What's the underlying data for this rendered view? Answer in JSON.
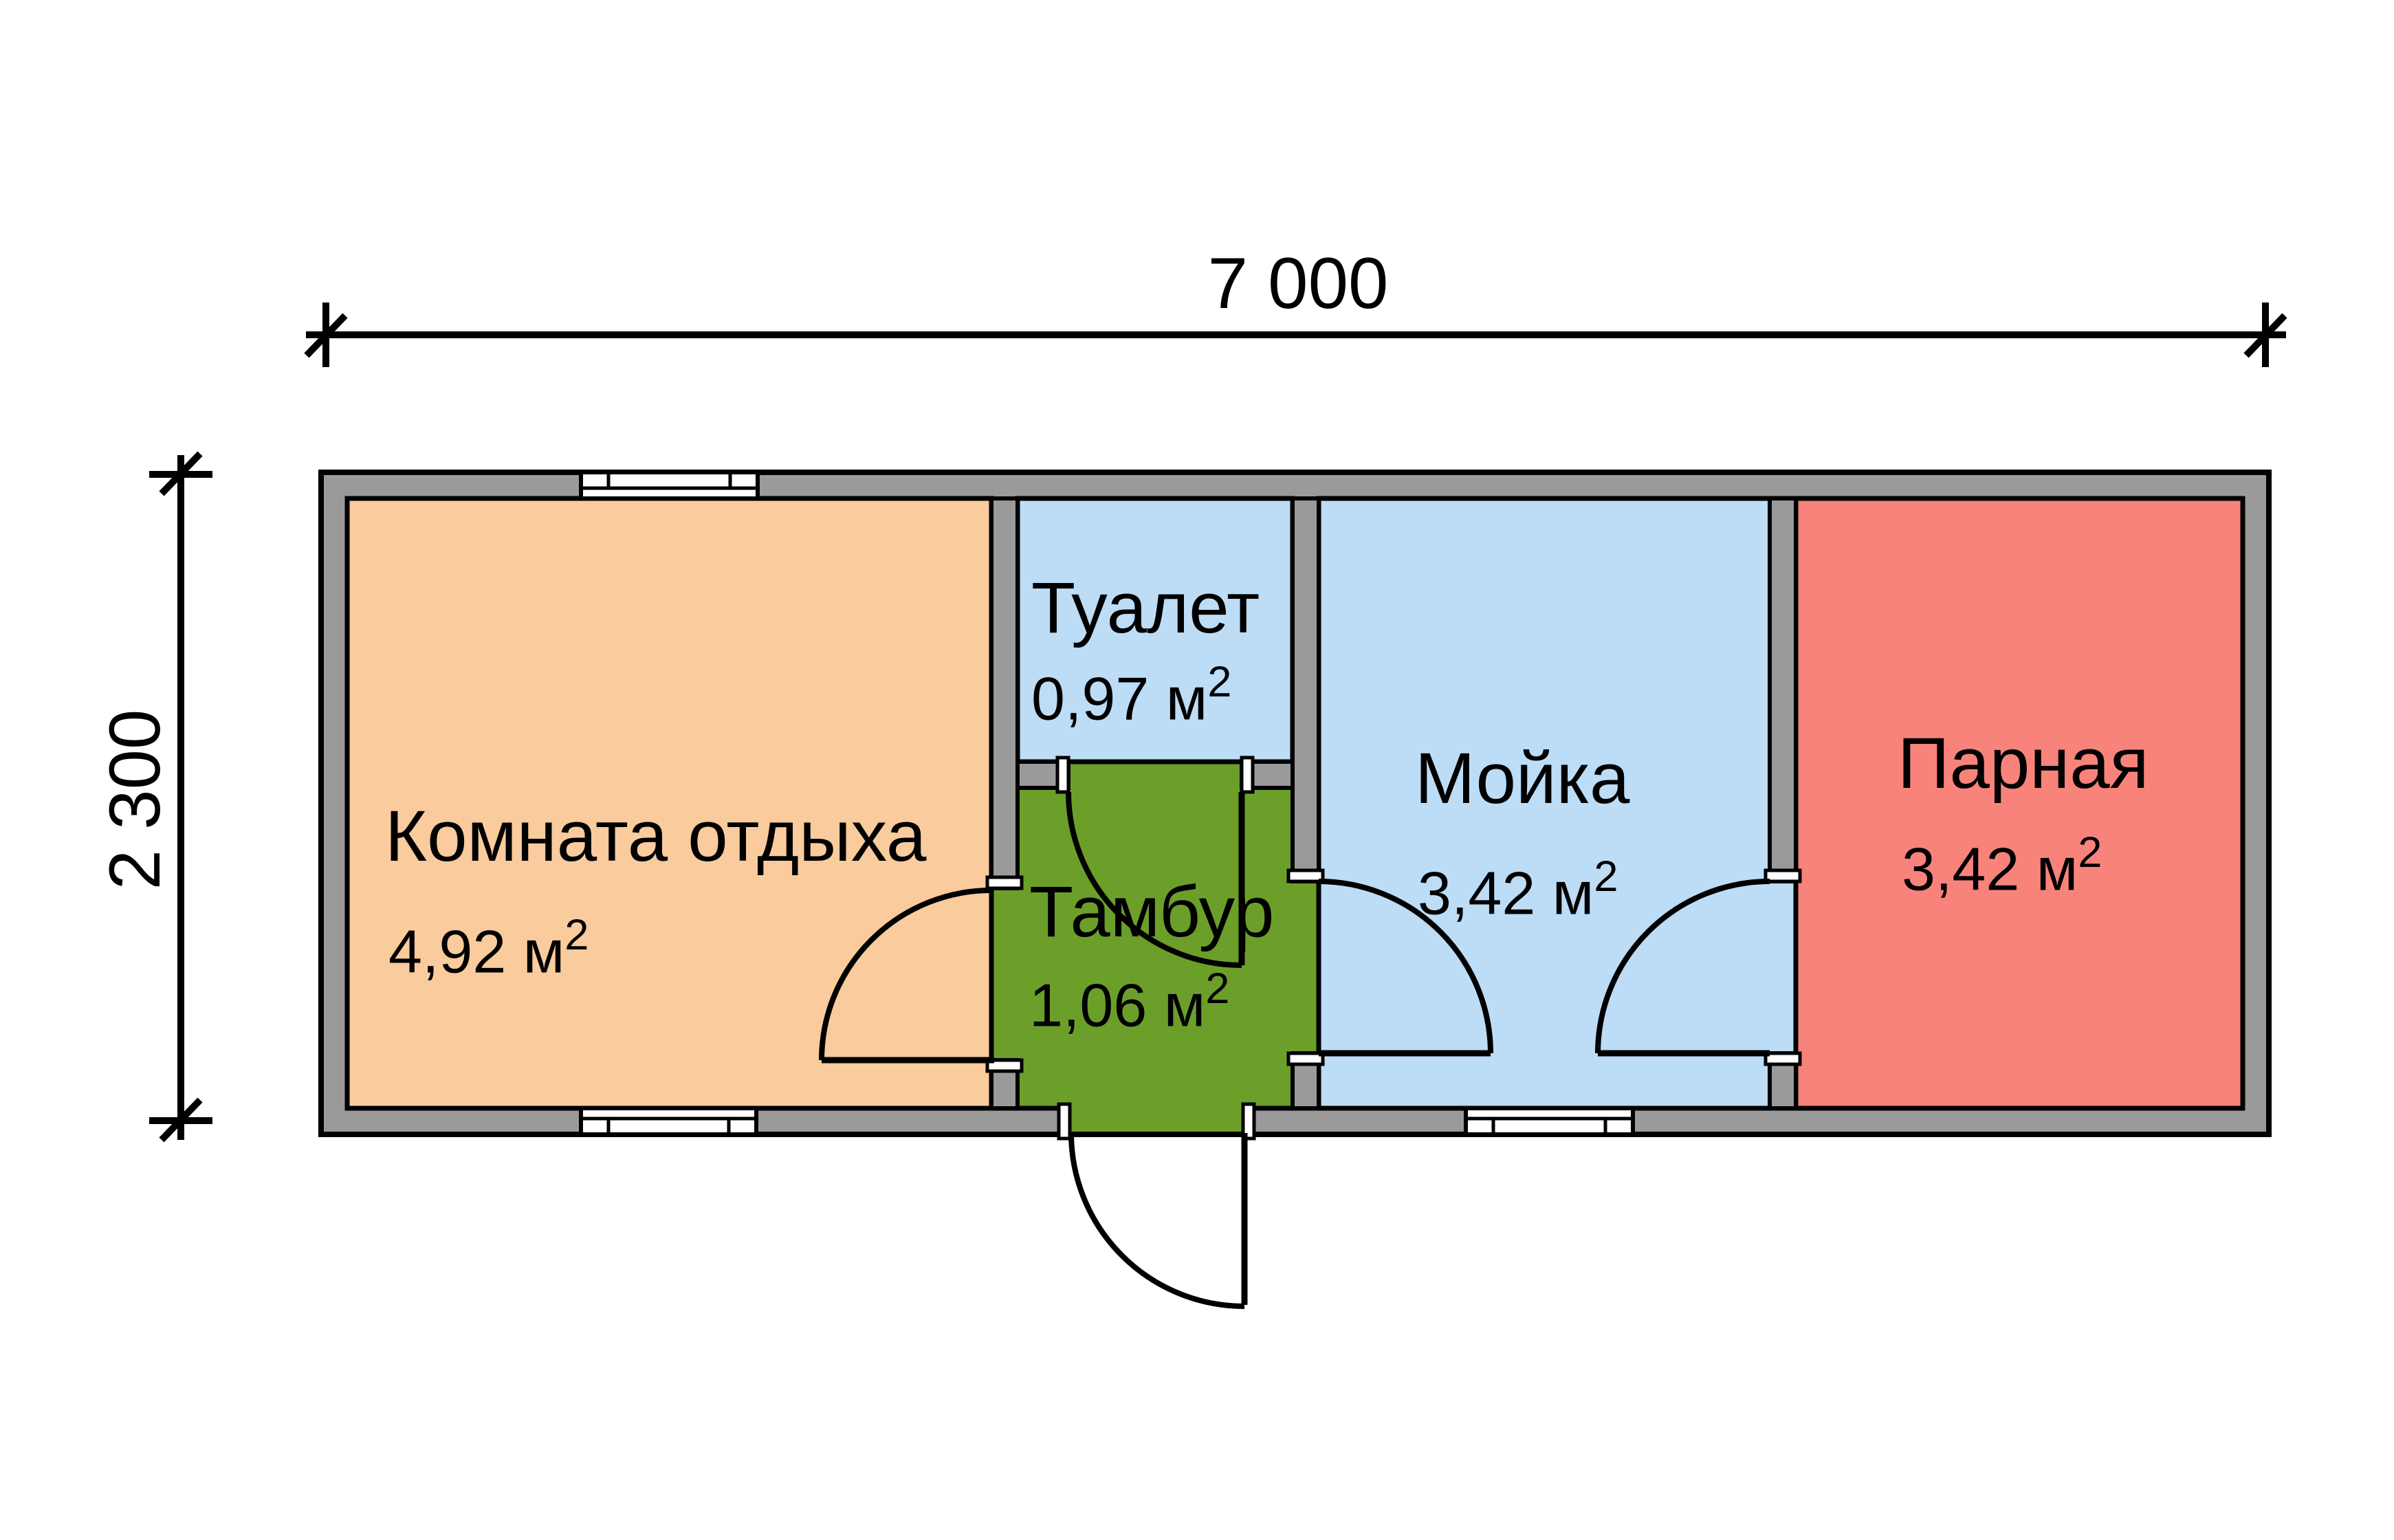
{
  "plan_title": "bathhouse-floor-plan",
  "dimensions": {
    "width_label": "7 000",
    "height_label": "2 300"
  },
  "rooms": [
    {
      "name": "Комната отдыха",
      "area": "4,92 м",
      "area_sup": "2"
    },
    {
      "name": "Туалет",
      "area": "0,97 м",
      "area_sup": "2"
    },
    {
      "name": "Тамбур",
      "area": "1,06 м",
      "area_sup": "2"
    },
    {
      "name": "Мойка",
      "area": "3,42 м",
      "area_sup": "2"
    },
    {
      "name": "Парная",
      "area": "3,42 м",
      "area_sup": "2"
    }
  ],
  "colors": {
    "lounge_floor": "#F9CB9D",
    "wet_floor": "#BDDCF6",
    "tambour_floor": "#6C9F2A",
    "steam_floor": "#F8837B",
    "wall_gray": "#9A9A9A",
    "outline": "#000000",
    "jamb_white": "#FFFFFF"
  }
}
